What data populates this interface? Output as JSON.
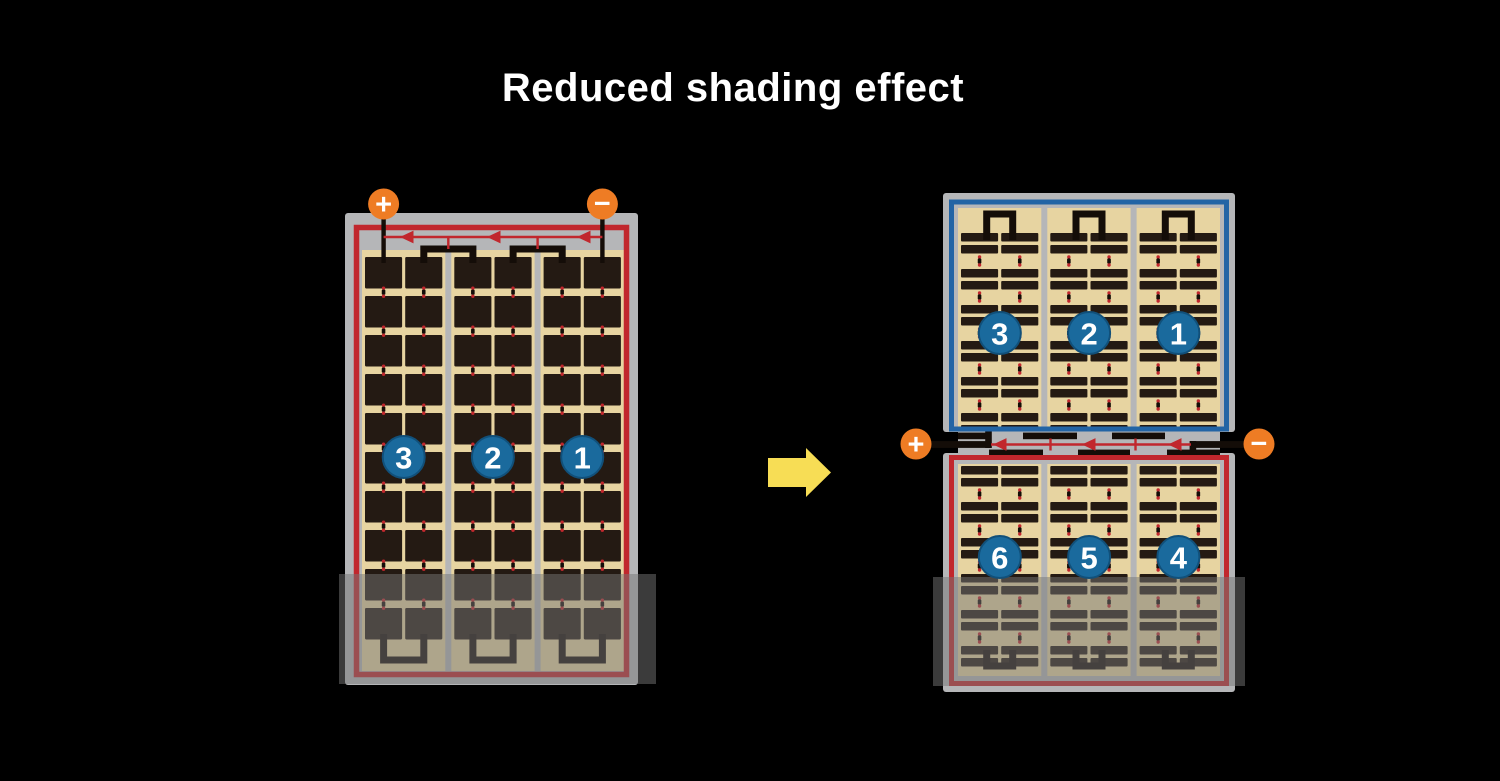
{
  "title": "Reduced shading effect",
  "colors": {
    "background": "#000000",
    "panel_frame_gray": "#b5b6b8",
    "cell_field_tan": "#e7d4a1",
    "cell_dark": "#241a13",
    "busbar_black": "#140d08",
    "border_red": "#c1272d",
    "border_blue": "#2264a5",
    "diode_red": "#c1272d",
    "terminal_orange": "#ee7c24",
    "string_badge_blue": "#1a6a9d",
    "arrow_yellow": "#f7dd55",
    "shade_overlay_gray": "#757575"
  },
  "before_panel": {
    "terminal_positive": "+",
    "terminal_negative": "−",
    "strings": [
      "3",
      "2",
      "1"
    ]
  },
  "after_panel": {
    "terminal_positive": "+",
    "terminal_negative": "−",
    "top_strings": [
      "3",
      "2",
      "1"
    ],
    "bottom_strings": [
      "6",
      "5",
      "4"
    ]
  }
}
